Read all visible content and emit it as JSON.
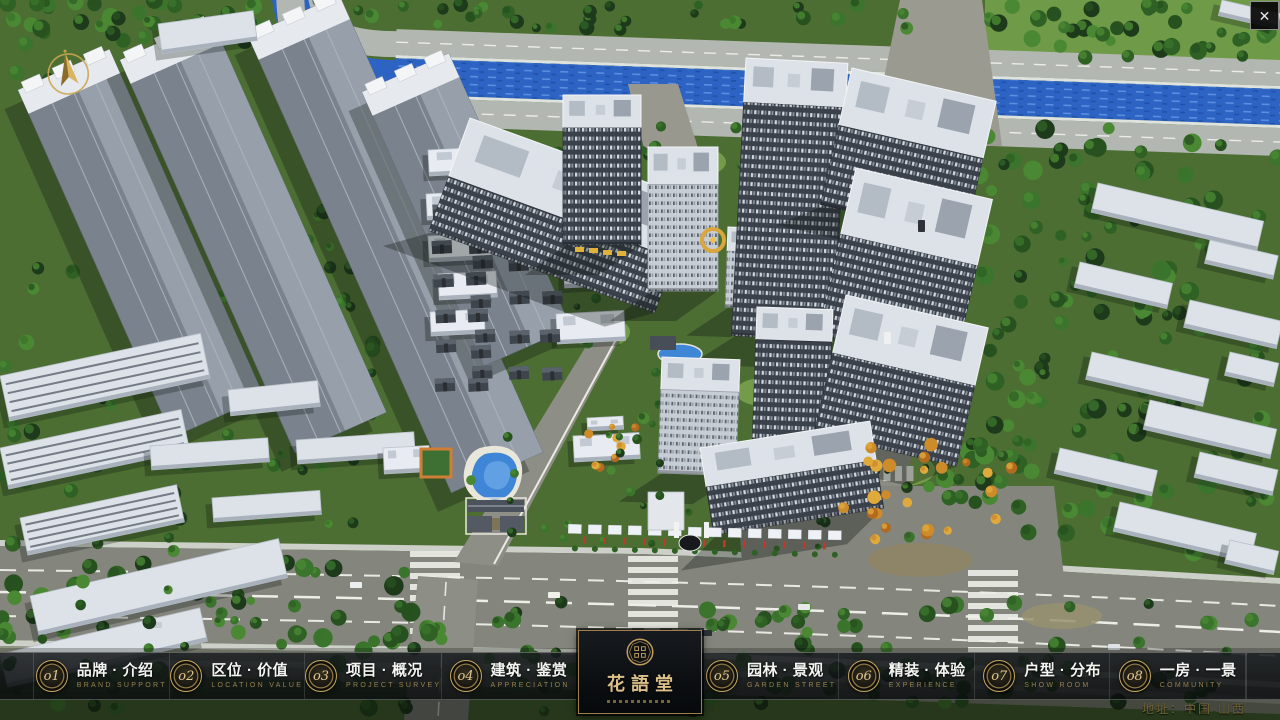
{
  "chrome": {
    "close_label": "✕"
  },
  "menu": {
    "items": [
      {
        "num": "o1",
        "zh": "品牌 · 介绍",
        "en": "BRAND SUPPORT"
      },
      {
        "num": "o2",
        "zh": "区位 · 价值",
        "en": "LOCATION VALUE"
      },
      {
        "num": "o3",
        "zh": "项目 · 概况",
        "en": "PROJECT SURVEY"
      },
      {
        "num": "o4",
        "zh": "建筑 · 鉴赏",
        "en": "APPRECIATION"
      },
      {
        "num": "o5",
        "zh": "园林 · 景观",
        "en": "GARDEN STREET"
      },
      {
        "num": "o6",
        "zh": "精装 · 体验",
        "en": "EXPERIENCE"
      },
      {
        "num": "o7",
        "zh": "户型 · 分布",
        "en": "SHOW ROOM"
      },
      {
        "num": "o8",
        "zh": "一房 · 一景",
        "en": "COMMUNITY"
      }
    ]
  },
  "logo": {
    "title": "花語堂"
  },
  "footer": {
    "address": "地址：中国·山西"
  },
  "colors": {
    "gold": "#c9a84c",
    "bar_bg": "#0c0e10",
    "river": "#2d63c2",
    "text_en": "#97814f"
  }
}
